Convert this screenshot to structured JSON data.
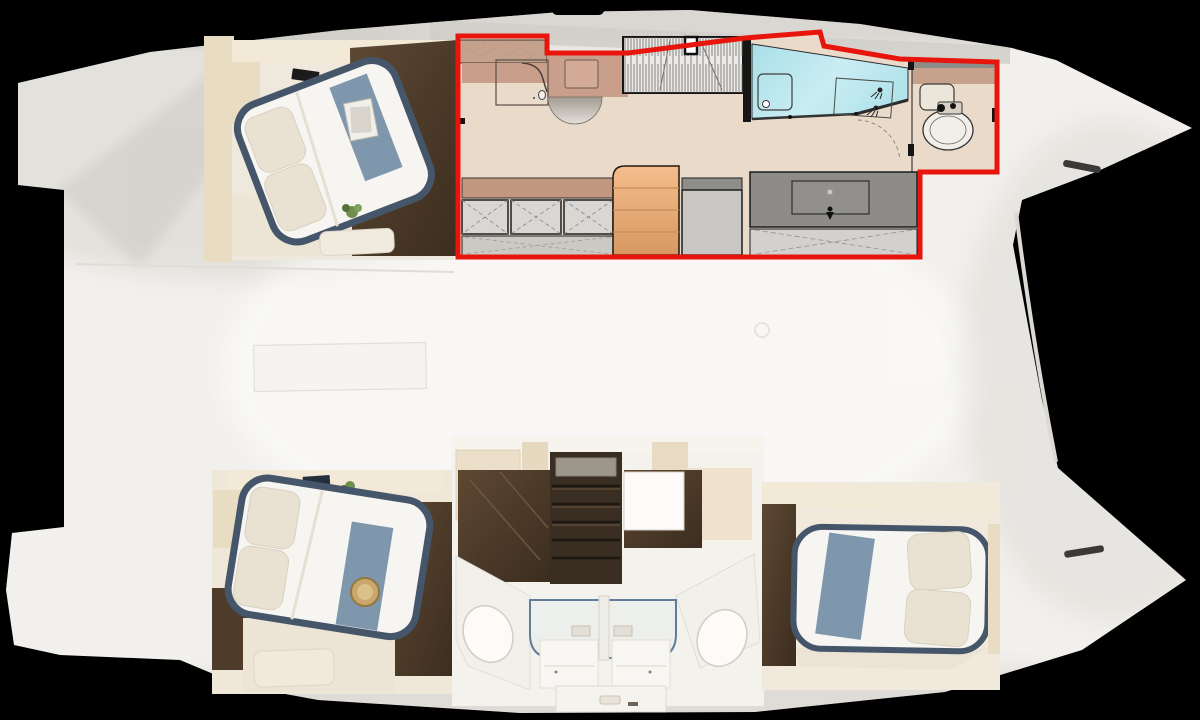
{
  "meta": {
    "view": "catamaran-deck-plan-top-view",
    "render_style": "3d-render-with-2d-plan-overlay",
    "visible_text": "none"
  },
  "colors": {
    "bg": "#000000",
    "hull": "#f2f0ec",
    "hull-edge": "#fbfbfa",
    "deck-shade": "#d2cfca",
    "highlight-red": "#e8150d",
    "plan-floor": "#eadaca",
    "counter-rose": "#c99e8b",
    "cabinet-tan": "#c6a28d",
    "sofa-rose": "#c2977f",
    "locker-gray": "#d8d7d4",
    "locker-floor": "#cbc9c4",
    "stairs-orange": "#eeb083",
    "stairs-orange-deep": "#db9c6a",
    "appliance-gray": "#c9c7c3",
    "appliance-gray-dark": "#8f8d89",
    "vanity-gray": "#8e8c88",
    "vanity-locker": "#d3d1cd",
    "shower-cyan": "#b7e5ec",
    "toilet-floor": "#e7dccf",
    "wood-dark": "#4e3b2a",
    "wall-beige": "#e8dcc2",
    "wall-cream": "#f2e9d6",
    "bed-frame": "#46566a",
    "bedding": "#f7f5f1",
    "pillow": "#e9e1d1",
    "throw-blue": "#7e97ad",
    "tray-wood": "#c9a76c",
    "plant-green": "#6f8f4f",
    "glass-blue": "#5f7d99",
    "furn-white": "#f8f6f2",
    "line-dark": "#1c1c1c"
  },
  "highlight": {
    "region": "aft-cabin-suite-2d-plan",
    "outline_color": "#e8150d",
    "contains": [
      "desk-vanity",
      "hanging-wardrobe",
      "companionway-stairs",
      "storage-lockers",
      "glass-shower",
      "wc-toilet",
      "sink-vanity"
    ]
  },
  "regions": {
    "top_hull": {
      "forward_cabin": "double-bed-cabin-with-throw-and-magazines",
      "aft_section": "highlighted-2d-floorplan-overlay"
    },
    "bridgedeck": "open-deck-with-hatch-outline",
    "bottom_hull": {
      "forward_cabin": "double-bed-cabin-with-round-tray",
      "midship": "twin-bathrooms-glass-shower-two-toilets-stairs",
      "aft_cabin": "double-bed-cabin-pillows-aft"
    }
  },
  "icons": [
    "hanger-icon",
    "shower-head-icon",
    "faucet-icon",
    "drain-icon",
    "door-swing-arc",
    "toilet-icon",
    "sink-icon",
    "vent-slit-icon"
  ]
}
